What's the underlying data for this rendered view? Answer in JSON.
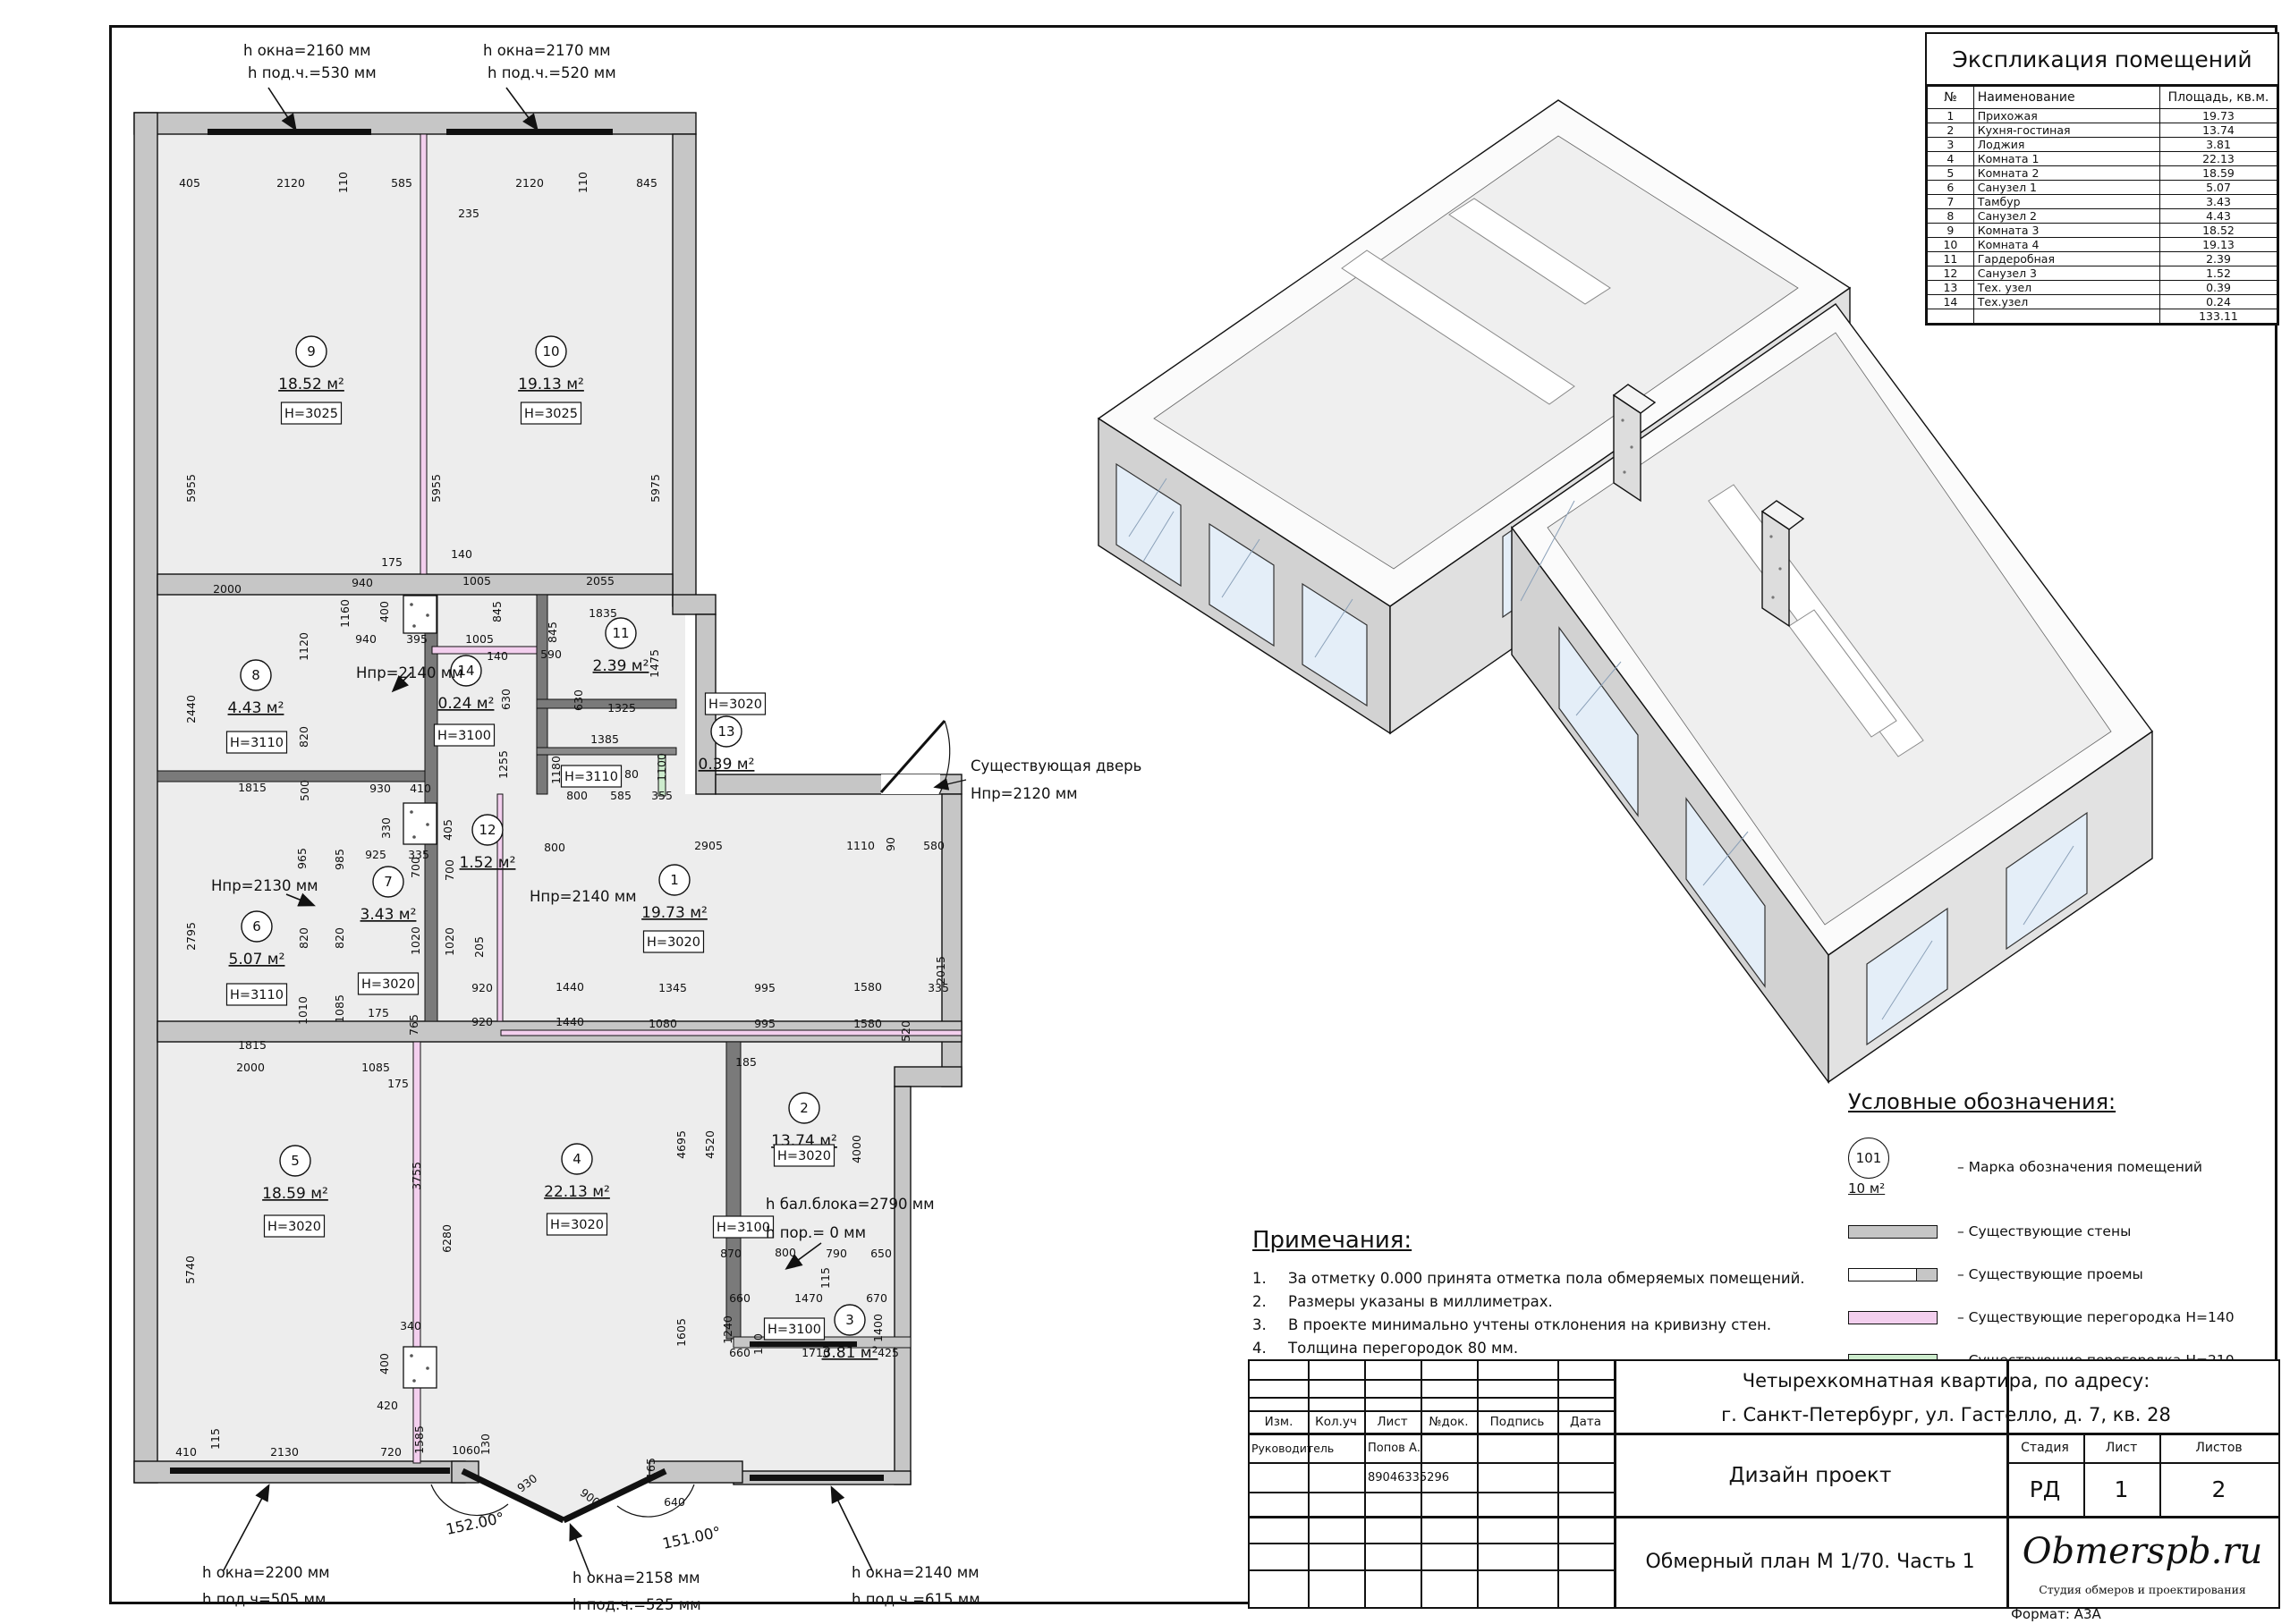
{
  "colors": {
    "wall": "#c6c6c6",
    "inner_wall": "#7a7a7a",
    "floor": "#ededed",
    "partition_h140": "#f3cfee",
    "partition_h210": "#cdeccd",
    "glass_3d": "#e4eef8"
  },
  "explication": {
    "title": "Экспликация помещений",
    "columns": [
      "№",
      "Наименование",
      "Площадь, кв.м."
    ],
    "rows": [
      [
        "1",
        "Прихожая",
        "19.73"
      ],
      [
        "2",
        "Кухня-гостиная",
        "13.74"
      ],
      [
        "3",
        "Лоджия",
        "3.81"
      ],
      [
        "4",
        "Комната 1",
        "22.13"
      ],
      [
        "5",
        "Комната 2",
        "18.59"
      ],
      [
        "6",
        "Санузел 1",
        "5.07"
      ],
      [
        "7",
        "Тамбур",
        "3.43"
      ],
      [
        "8",
        "Санузел 2",
        "4.43"
      ],
      [
        "9",
        "Комната 3",
        "18.52"
      ],
      [
        "10",
        "Комната 4",
        "19.13"
      ],
      [
        "11",
        "Гардеробная",
        "2.39"
      ],
      [
        "12",
        "Санузел 3",
        "1.52"
      ],
      [
        "13",
        "Тех. узел",
        "0.39"
      ],
      [
        "14",
        "Тех.узел",
        "0.24"
      ]
    ],
    "total": "133.11"
  },
  "legend": {
    "title": "Условные обозначения:",
    "mark_label": "101",
    "mark_sub": "10 м²",
    "items": [
      {
        "type": "mark",
        "label": "– Марка обозначения помещений"
      },
      {
        "type": "bar",
        "color": "#c6c6c6",
        "label": "– Существующие стены"
      },
      {
        "type": "opening",
        "color": "#ffffff",
        "label": "– Существующие проемы"
      },
      {
        "type": "bar",
        "color": "#f3cfee",
        "label": "– Существующие перегородка Н=140"
      },
      {
        "type": "bar",
        "color": "#cdeccd",
        "label": "– Существующие перегородка Н=210"
      }
    ]
  },
  "notes": {
    "title": "Примечания:",
    "items": [
      "За отметку 0.000 принята отметка пола обмеряемых помещений.",
      "Размеры указаны в миллиметрах.",
      "В проекте минимально учтены отклонения на кривизну стен.",
      "Толщина перегородок 80 мм."
    ]
  },
  "title_block": {
    "address_line1": "Четырехкомнатная квартира, по адресу:",
    "address_line2": "г. Санкт-Петербург, ул. Гастелло, д. 7, кв. 28",
    "columns": [
      "Изм.",
      "Кол.уч",
      "Лист",
      "№док.",
      "Подпись",
      "Дата"
    ],
    "role_label": "Руководитель",
    "role_name": "Попов А.",
    "phone": "89046335296",
    "project_type": "Дизайн проект",
    "stage_label": "Стадия",
    "sheet_label": "Лист",
    "sheets_label": "Листов",
    "stage": "РД",
    "sheet": "1",
    "sheets": "2",
    "drawing_title": "Обмерный план М 1/70. Часть 1",
    "logo": "Obmerspb.ru",
    "logo_sub": "Студия обмеров и проектирования",
    "format_label": "Формат: А3А"
  },
  "plan": {
    "rooms": [
      [
        "9",
        348,
        393,
        "18.52 м²",
        "H=3025",
        348,
        462
      ],
      [
        "10",
        616,
        393,
        "19.13 м²",
        "H=3025",
        616,
        462
      ],
      [
        "8",
        286,
        755,
        "4.43 м²",
        "H=3110",
        287,
        830
      ],
      [
        "14",
        521,
        750,
        "0.24 м²",
        "H=3100",
        519,
        822
      ],
      [
        "11",
        694,
        708,
        "2.39 м²",
        "H=3020",
        822,
        787
      ],
      [
        "13",
        812,
        818,
        "0.39 м²",
        null,
        0,
        0
      ],
      [
        "12",
        545,
        928,
        "1.52 м²",
        "H=3110",
        661,
        868
      ],
      [
        "6",
        287,
        1036,
        "5.07 м²",
        "H=3110",
        287,
        1112
      ],
      [
        "7",
        434,
        986,
        "3.43 м²",
        "H=3020",
        434,
        1100
      ],
      [
        "1",
        754,
        984,
        "19.73 м²",
        "H=3020",
        753,
        1053
      ],
      [
        "5",
        330,
        1298,
        "18.59 м²",
        "H=3020",
        329,
        1371
      ],
      [
        "4",
        645,
        1296,
        "22.13 м²",
        "H=3020",
        645,
        1369
      ],
      [
        "2",
        899,
        1239,
        "13.74 м²",
        "H=3020",
        899,
        1292
      ],
      [
        "3",
        950,
        1476,
        "3.81 м²",
        "H=3100",
        888,
        1486
      ]
    ],
    "extra_boxes": [
      [
        "H=3100",
        831,
        1372
      ]
    ],
    "dims": [
      [
        "405",
        212,
        209,
        0
      ],
      [
        "2120",
        325,
        209,
        0
      ],
      [
        "110",
        388,
        204,
        1
      ],
      [
        "585",
        449,
        209,
        0
      ],
      [
        "235",
        524,
        243,
        0
      ],
      [
        "2120",
        592,
        209,
        0
      ],
      [
        "110",
        656,
        204,
        1
      ],
      [
        "845",
        723,
        209,
        0
      ],
      [
        "5955",
        218,
        546,
        1
      ],
      [
        "5955",
        492,
        546,
        1
      ],
      [
        "5975",
        737,
        546,
        1
      ],
      [
        "2000",
        254,
        663,
        0
      ],
      [
        "940",
        405,
        656,
        0
      ],
      [
        "175",
        438,
        633,
        0
      ],
      [
        "140",
        516,
        624,
        0
      ],
      [
        "1005",
        533,
        654,
        0
      ],
      [
        "2055",
        671,
        654,
        0
      ],
      [
        "940",
        409,
        719,
        0
      ],
      [
        "395",
        466,
        719,
        0
      ],
      [
        "1005",
        536,
        719,
        0
      ],
      [
        "1160",
        390,
        686,
        1
      ],
      [
        "400",
        434,
        684,
        1
      ],
      [
        "845",
        560,
        684,
        1
      ],
      [
        "845",
        622,
        707,
        1
      ],
      [
        "1835",
        674,
        690,
        0
      ],
      [
        "590",
        616,
        736,
        0
      ],
      [
        "140",
        556,
        738,
        0
      ],
      [
        "1475",
        736,
        742,
        1
      ],
      [
        "630",
        570,
        782,
        1
      ],
      [
        "630",
        651,
        783,
        1
      ],
      [
        "1325",
        695,
        796,
        0
      ],
      [
        "1120",
        344,
        723,
        1
      ],
      [
        "820",
        344,
        824,
        1
      ],
      [
        "500",
        345,
        884,
        1
      ],
      [
        "2440",
        218,
        793,
        1
      ],
      [
        "1815",
        282,
        885,
        0
      ],
      [
        "2795",
        218,
        1047,
        1
      ],
      [
        "1815",
        282,
        1173,
        0
      ],
      [
        "965",
        342,
        960,
        1
      ],
      [
        "820",
        384,
        1049,
        1
      ],
      [
        "1010",
        343,
        1130,
        1
      ],
      [
        "985",
        384,
        961,
        1
      ],
      [
        "820",
        344,
        1049,
        1
      ],
      [
        "1085",
        384,
        1128,
        1
      ],
      [
        "930",
        425,
        886,
        0
      ],
      [
        "410",
        470,
        886,
        0
      ],
      [
        "330",
        436,
        926,
        1
      ],
      [
        "405",
        505,
        928,
        1
      ],
      [
        "925",
        420,
        960,
        0
      ],
      [
        "335",
        468,
        960,
        0
      ],
      [
        "700",
        469,
        970,
        1
      ],
      [
        "700",
        507,
        973,
        1
      ],
      [
        "1020",
        469,
        1052,
        1
      ],
      [
        "1020",
        507,
        1053,
        1
      ],
      [
        "205",
        540,
        1059,
        1
      ],
      [
        "920",
        539,
        1109,
        0
      ],
      [
        "1440",
        637,
        1108,
        0
      ],
      [
        "1345",
        752,
        1109,
        0
      ],
      [
        "995",
        855,
        1109,
        0
      ],
      [
        "1580",
        970,
        1108,
        0
      ],
      [
        "335",
        1049,
        1109,
        0
      ],
      [
        "920",
        539,
        1147,
        0
      ],
      [
        "1440",
        637,
        1147,
        0
      ],
      [
        "1080",
        741,
        1149,
        0
      ],
      [
        "995",
        855,
        1149,
        0
      ],
      [
        "1580",
        970,
        1149,
        0
      ],
      [
        "520",
        1017,
        1153,
        1
      ],
      [
        "175",
        423,
        1137,
        0
      ],
      [
        "765",
        467,
        1146,
        1
      ],
      [
        "2000",
        280,
        1198,
        0
      ],
      [
        "1085",
        420,
        1198,
        0
      ],
      [
        "175",
        445,
        1216,
        0
      ],
      [
        "185",
        834,
        1192,
        0
      ],
      [
        "1385",
        676,
        831,
        0
      ],
      [
        "1180",
        626,
        861,
        1
      ],
      [
        "800",
        645,
        894,
        0
      ],
      [
        "585",
        694,
        894,
        0
      ],
      [
        "80",
        706,
        870,
        0
      ],
      [
        "355",
        740,
        894,
        0
      ],
      [
        "1100",
        744,
        858,
        1
      ],
      [
        "1255",
        567,
        855,
        1
      ],
      [
        "800",
        620,
        952,
        0
      ],
      [
        "2905",
        792,
        950,
        0
      ],
      [
        "1110",
        962,
        950,
        0
      ],
      [
        "90",
        1000,
        944,
        1
      ],
      [
        "580",
        1044,
        950,
        0
      ],
      [
        "2015",
        1056,
        1085,
        1
      ],
      [
        "3755",
        470,
        1315,
        1
      ],
      [
        "6280",
        504,
        1385,
        1
      ],
      [
        "5740",
        217,
        1420,
        1
      ],
      [
        "340",
        459,
        1487,
        0
      ],
      [
        "400",
        434,
        1525,
        1
      ],
      [
        "420",
        433,
        1576,
        0
      ],
      [
        "1585",
        473,
        1610,
        1
      ],
      [
        "115",
        245,
        1609,
        1
      ],
      [
        "410",
        208,
        1628,
        0
      ],
      [
        "2130",
        318,
        1628,
        0
      ],
      [
        "720",
        437,
        1628,
        0
      ],
      [
        "1060",
        521,
        1626,
        0
      ],
      [
        "130",
        547,
        1615,
        1
      ],
      [
        "930",
        592,
        1662,
        -37
      ],
      [
        "900",
        657,
        1678,
        37
      ],
      [
        "165",
        732,
        1642,
        1
      ],
      [
        "640",
        754,
        1684,
        0
      ],
      [
        "4695",
        766,
        1280,
        1
      ],
      [
        "4520",
        798,
        1280,
        1
      ],
      [
        "4000",
        962,
        1285,
        1
      ],
      [
        "870",
        817,
        1406,
        0
      ],
      [
        "800",
        878,
        1405,
        0
      ],
      [
        "790",
        935,
        1406,
        0
      ],
      [
        "650",
        985,
        1406,
        0
      ],
      [
        "115",
        927,
        1429,
        1
      ],
      [
        "1605",
        766,
        1490,
        1
      ],
      [
        "660",
        827,
        1456,
        0
      ],
      [
        "1470",
        904,
        1456,
        0
      ],
      [
        "670",
        980,
        1456,
        0
      ],
      [
        "1240",
        818,
        1487,
        1
      ],
      [
        "1400",
        986,
        1485,
        1
      ],
      [
        "160",
        852,
        1503,
        1
      ],
      [
        "660",
        827,
        1517,
        0
      ],
      [
        "1710",
        912,
        1517,
        0
      ],
      [
        "425",
        993,
        1517,
        0
      ]
    ],
    "annotations": [
      [
        "h окна=2160 мм",
        272,
        62,
        0
      ],
      [
        "h под.ч.=530 мм",
        277,
        87,
        0
      ],
      [
        "h окна=2170 мм",
        540,
        62,
        0
      ],
      [
        "h под.ч.=520 мм",
        545,
        87,
        0
      ],
      [
        "Hпр=2140 мм",
        398,
        758,
        0
      ],
      [
        "Hпр=2130 мм",
        236,
        996,
        0
      ],
      [
        "Hпр=2140 мм",
        592,
        1008,
        0
      ],
      [
        "Существующая дверь",
        1085,
        862,
        0
      ],
      [
        "Hпр=2120 мм",
        1085,
        893,
        0
      ],
      [
        "h бал.блока=2790 мм",
        856,
        1352,
        0
      ],
      [
        "h пор.= 0 мм",
        856,
        1384,
        0
      ],
      [
        "152.00°",
        500,
        1716,
        -12
      ],
      [
        "151.00°",
        742,
        1732,
        -12
      ],
      [
        "h окна=2200 мм",
        226,
        1764,
        0
      ],
      [
        "h под.ч=505 мм",
        226,
        1794,
        0
      ],
      [
        "h окна=2158 мм",
        640,
        1770,
        0
      ],
      [
        "h под.ч.=525 мм",
        640,
        1800,
        0
      ],
      [
        "h окна=2140 мм",
        952,
        1764,
        0
      ],
      [
        "h под.ч.=615 мм",
        952,
        1794,
        0
      ]
    ]
  }
}
